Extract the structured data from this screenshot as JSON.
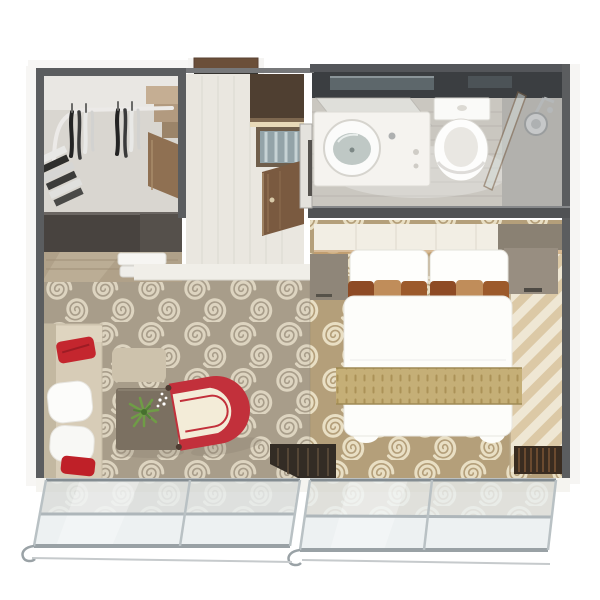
{
  "meta": {
    "type": "3d-floorplan-render",
    "subject": "Top-down 3D rendering of a suite floor plan with walk-in closet, bathroom, bedroom, living area and balcony glass doors",
    "canvas": {
      "width": 600,
      "height": 600
    }
  },
  "rooms": [
    {
      "id": "walk-in-closet",
      "label": "Walk-in closet",
      "features": [
        "clothes-rail",
        "hanging-garments",
        "folded-clothes-shelves",
        "corner-step-shelves",
        "dresser",
        "towel-stack"
      ]
    },
    {
      "id": "entry-hall",
      "label": "Entry hall",
      "floor": "light wood planks",
      "features": [
        "entry-door",
        "wall-cabinet",
        "glass-front-cabinet",
        "open-wood-door"
      ]
    },
    {
      "id": "bathroom",
      "label": "Bathroom",
      "features": [
        "vanity-counter",
        "round-sink",
        "mirror",
        "toilet",
        "shower-glass-panel",
        "shower-head"
      ]
    },
    {
      "id": "bedroom",
      "label": "Bedroom",
      "features": [
        "headboard-ledge",
        "double-bed",
        "white-pillows",
        "striped-accent-pillows",
        "bed-runner",
        "nightstand-left",
        "nightstand-right",
        "striped-drapes",
        "drape-fringe"
      ]
    },
    {
      "id": "living-area",
      "label": "Living area",
      "features": [
        "sofa",
        "red-cushions",
        "white-cushions",
        "side-table",
        "coffee-table",
        "potted-plant",
        "red-armchair"
      ]
    },
    {
      "id": "balcony",
      "label": "Balcony",
      "features": [
        "sliding-glass-door-left",
        "sliding-glass-door-right",
        "railing"
      ]
    }
  ],
  "palette": {
    "background": "#ffffff",
    "walls": "#5b5d5f",
    "wall_outer_face": "#f6f5f3",
    "living_carpet_base": "#a89d8a",
    "living_carpet_swirl": "#ddd4c0",
    "bedroom_carpet_base": "#b49f7a",
    "bedroom_carpet_swirl": "#e9dfc4",
    "accent_red": "#c4262e",
    "armchair_red": "#c2303b",
    "armchair_seat": "#f3ecd8",
    "bed_linen": "#fdfdfa",
    "pillow_rust": "#8e4b25",
    "pillow_tan": "#c08d5a",
    "bed_runner_gold": "#c5af77",
    "wood_dark": "#7a5a40",
    "dresser_dark": "#48433f",
    "bathroom_floor": "#cac7c0",
    "glass_tint": "#dce3e6",
    "frame_silver": "#99a1a5"
  }
}
